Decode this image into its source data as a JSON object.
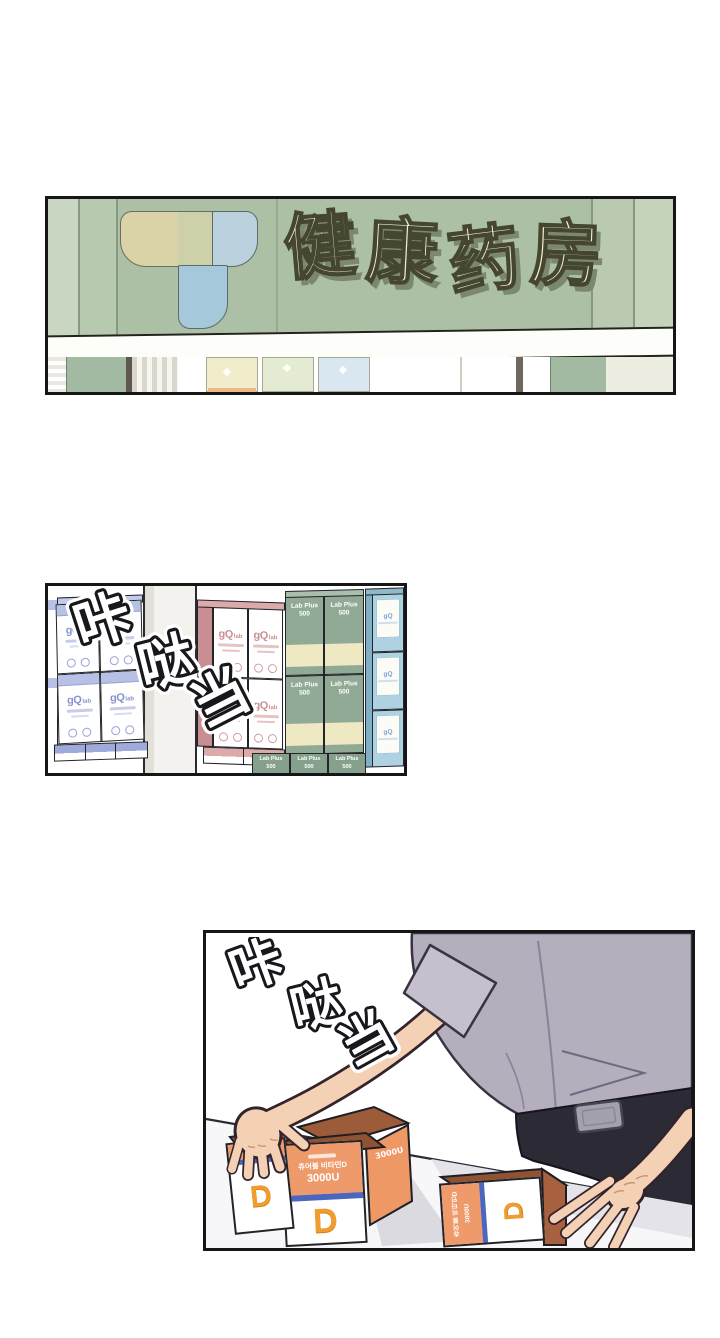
{
  "sign": {
    "text": "健康药房",
    "c1": "健",
    "c2": "康",
    "c3": "药",
    "c4": "房"
  },
  "sfx": {
    "text": "咔哒当",
    "c1": "咔",
    "c2": "哒",
    "c3": "当"
  },
  "brands": {
    "gq": "gQ",
    "gq_sub": "lab",
    "labplus": "Lab Plus",
    "labplus_qty": "500"
  },
  "vitamin": {
    "label": "츄어블 비타민D",
    "dose": "3000U",
    "letter": "D"
  },
  "colors": {
    "sign_green": "#abc0a5",
    "sign_cream": "#f4f1d3",
    "periwinkle": "#b7c0e5",
    "pink": "#c98e91",
    "box_green": "#91aa96",
    "teal": "#aed2e1",
    "box_orange": "#ef9a6b",
    "stripe_blue": "#4a66bd",
    "skin": "#f4d0b5",
    "shirt": "#b5aebd",
    "pants": "#2b2a35"
  }
}
